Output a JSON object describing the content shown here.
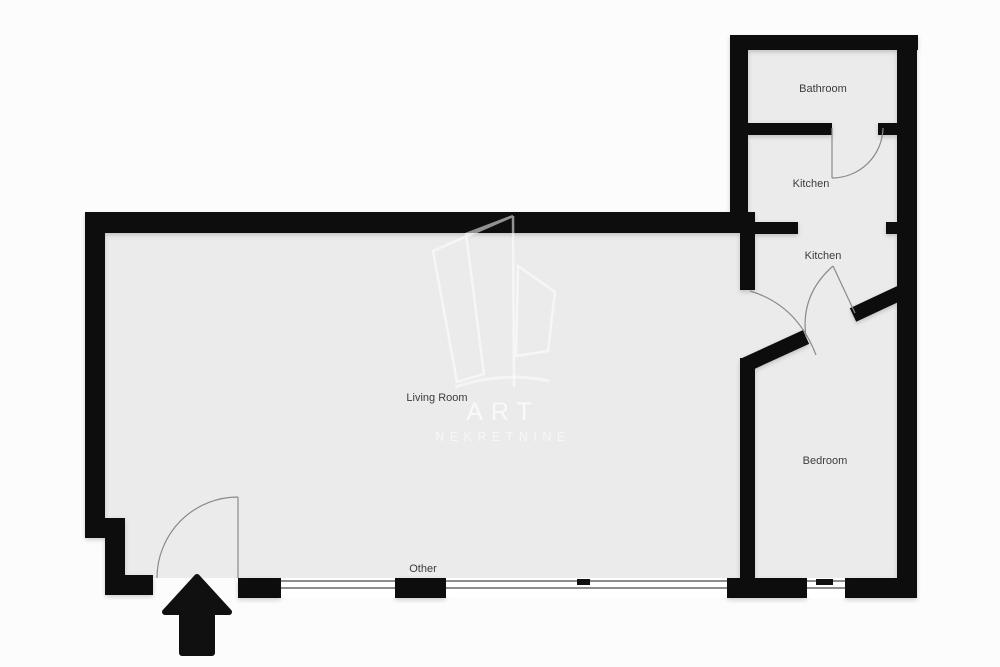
{
  "floorplan": {
    "rooms": [
      {
        "id": "bathroom",
        "label": "Bathroom"
      },
      {
        "id": "kitchen-upper",
        "label": "Kitchen"
      },
      {
        "id": "kitchen-lower",
        "label": "Kitchen"
      },
      {
        "id": "living-room",
        "label": "Living Room"
      },
      {
        "id": "bedroom",
        "label": "Bedroom"
      },
      {
        "id": "other",
        "label": "Other"
      }
    ],
    "watermark": {
      "line1": "ART",
      "line2": "NEKRETNINE"
    },
    "colors": {
      "wall": "#101010",
      "floor": "#ebebeb",
      "background": "#fcfcfc",
      "label_text": "#3c3c3c",
      "door_stroke": "#8a8a8a",
      "watermark": "#ffffff"
    }
  }
}
